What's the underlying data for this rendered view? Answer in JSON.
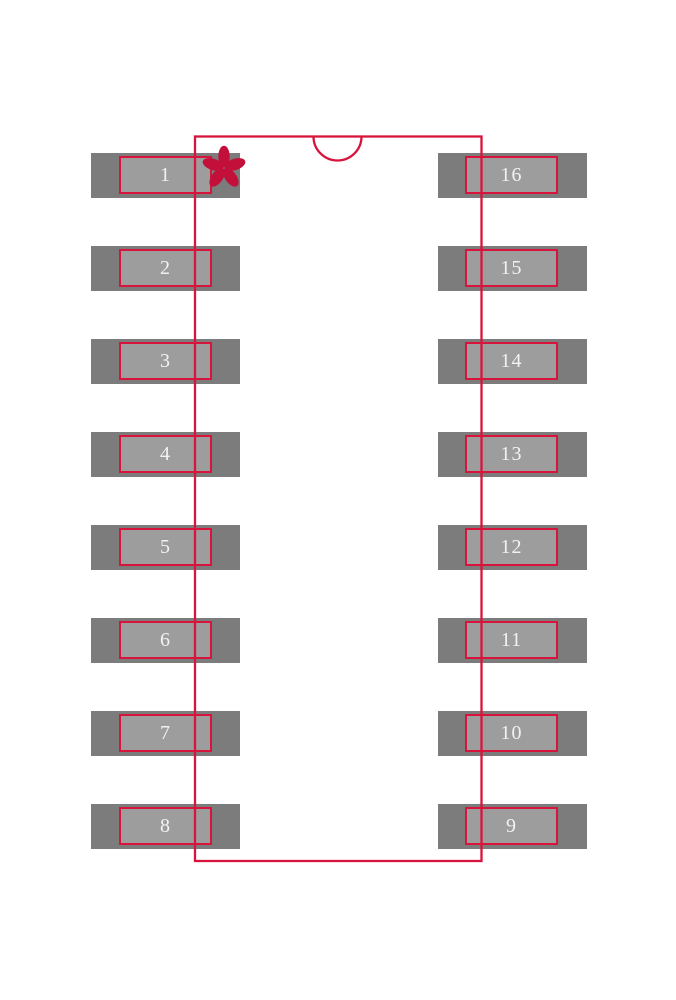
{
  "pads": {
    "left": [
      "1",
      "2",
      "3",
      "4",
      "5",
      "6",
      "7",
      "8"
    ],
    "right": [
      "16",
      "15",
      "14",
      "13",
      "12",
      "11",
      "10",
      "9"
    ]
  },
  "icons": {
    "pin1_marker": "asterisk-star",
    "orientation_notch": "semicircle-notch"
  },
  "colors": {
    "background": "#ffffff",
    "outline_red": "#d8143c",
    "pin1_marker_red": "#c2103a",
    "pad_copper_gray": "#7c7c7c",
    "pad_paste_gray": "#9d9d9d",
    "pad_number_text": "#f2f2f2"
  }
}
